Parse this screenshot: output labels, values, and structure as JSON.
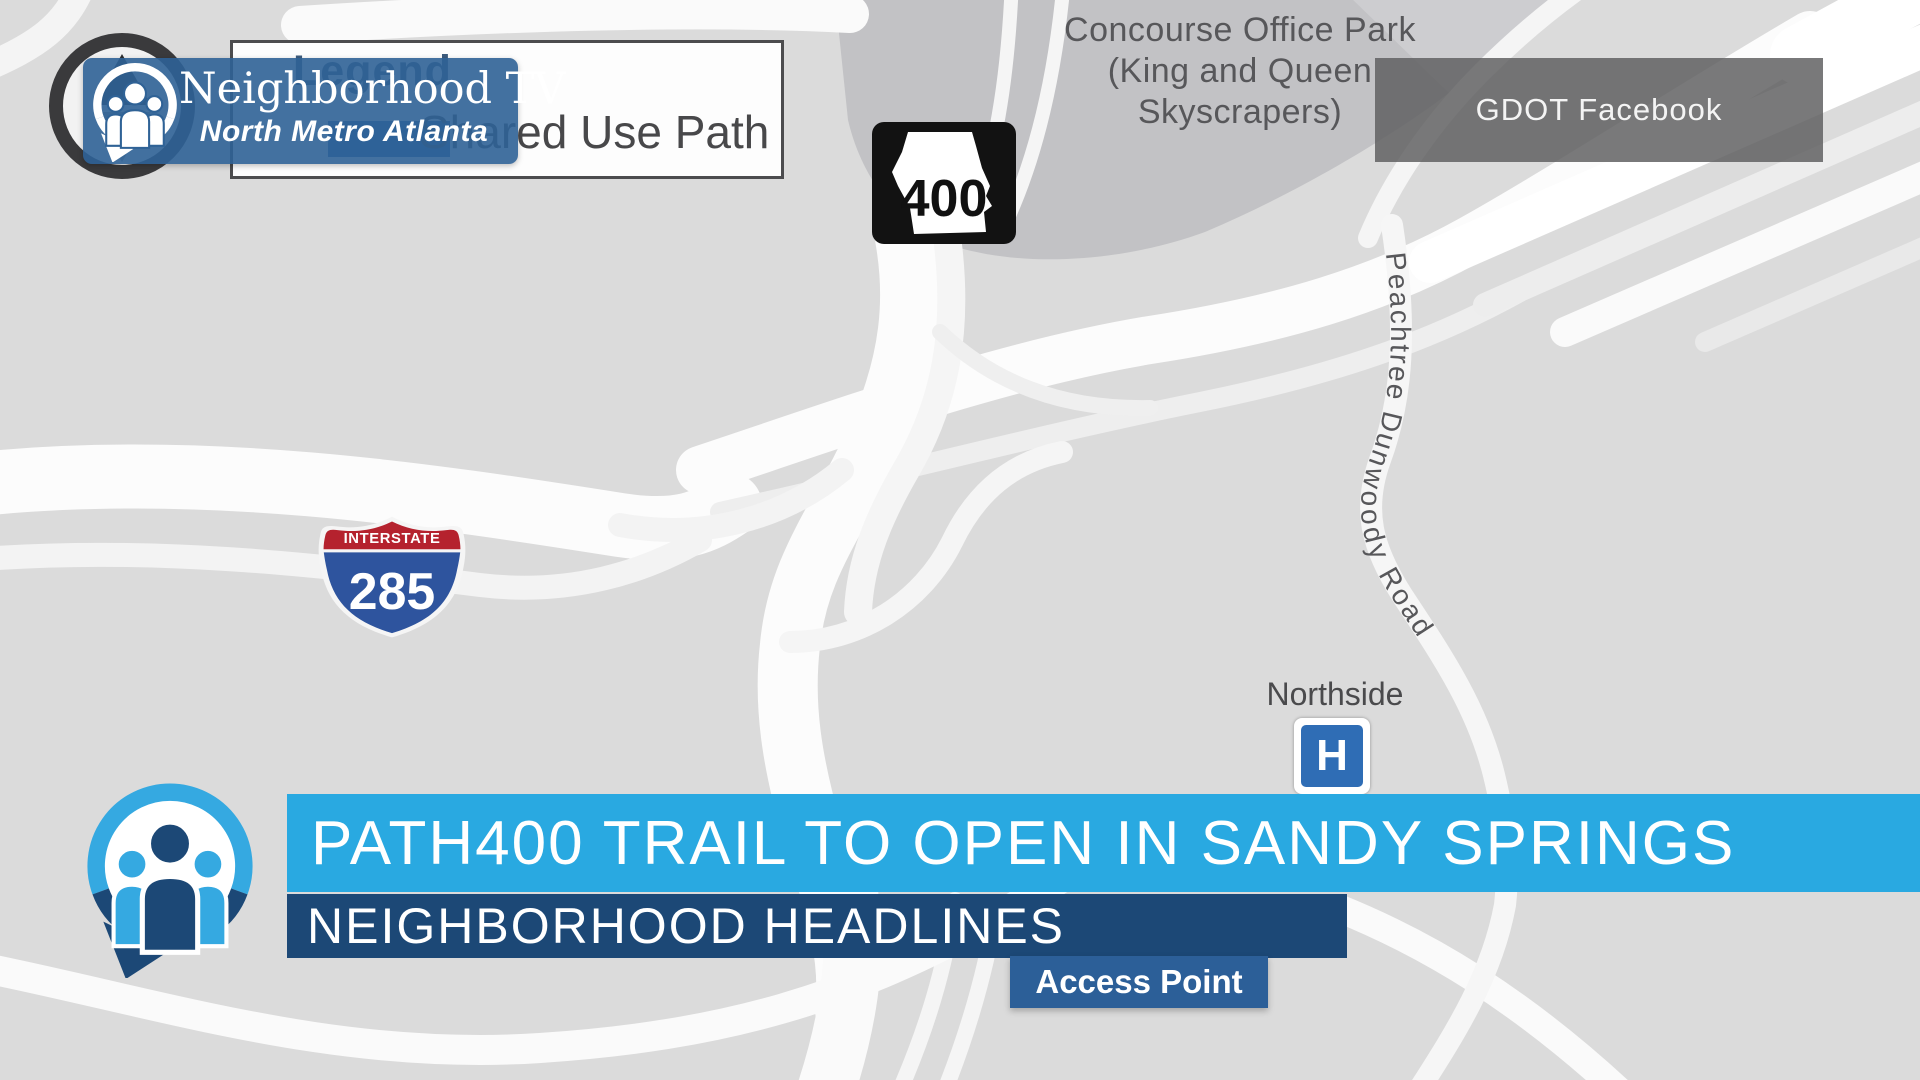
{
  "branding": {
    "station": "Neighborhood TV",
    "region": "North Metro Atlanta"
  },
  "legend": {
    "title": "Legend",
    "item": "Shared Use Path"
  },
  "map": {
    "office_park_lines": [
      "Concourse Office Park",
      "(King and Queen",
      "Skyscrapers)"
    ],
    "road_label": "Peachtree Dunwoody Road",
    "hospital_label": "Northside",
    "hospital_symbol": "H",
    "access_point_label": "Access Point",
    "credit_label": "GDOT Facebook",
    "state_route_number": "400",
    "interstate_label": "INTERSTATE",
    "interstate_number": "285"
  },
  "lower_third": {
    "headline": "PATH400 TRAIL TO OPEN IN SANDY SPRINGS",
    "topic": "NEIGHBORHOOD HEADLINES"
  },
  "colors": {
    "light_blue": "#29a9e1",
    "navy": "#1c4876",
    "banner_blue": "#2f6296",
    "access_blue": "#2c5f98",
    "interstate_red": "#b5222e",
    "interstate_blue": "#2e549e",
    "hospital_blue": "#2f6db5",
    "map_background": "#dbdbdb",
    "road_white": "#fafafa",
    "block_gray": "#c2c2c5"
  }
}
